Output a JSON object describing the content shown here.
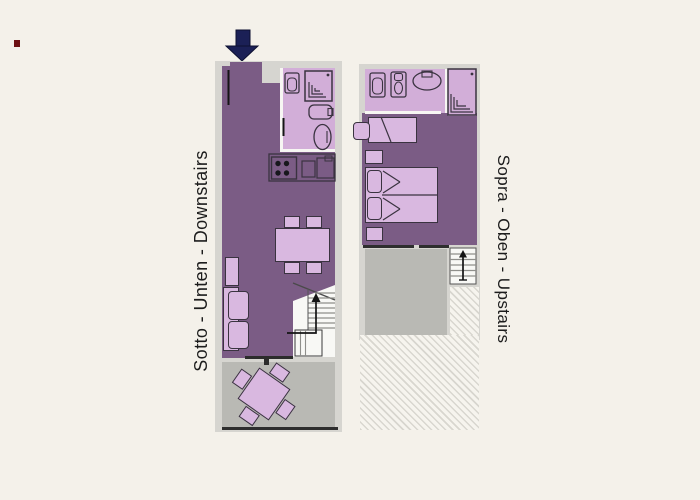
{
  "title": "Apartment floor plans",
  "floors": {
    "downstairs": {
      "label": "Sotto - Unten - Downstairs",
      "rooms": [
        "living-dining-room",
        "kitchen",
        "bathroom",
        "staircase",
        "terrace"
      ],
      "elements": [
        "entrance-arrow-icon",
        "toilet-icon",
        "shower-icon",
        "bathtub-icon",
        "bidet-icon",
        "stove-icon",
        "kitchen-sink-icon",
        "dining-table",
        "dining-chairs",
        "armchair",
        "sofa",
        "stairs-up-arrow-icon",
        "terrace-table"
      ]
    },
    "upstairs": {
      "label": "Sopra - Oben - Upstairs",
      "rooms": [
        "bedroom",
        "bathroom",
        "staircase",
        "terrace",
        "open-void"
      ],
      "elements": [
        "toilet-icon",
        "bidet-icon",
        "washbasin-icon",
        "shower-icon",
        "single-bed",
        "double-bed",
        "nightstand",
        "stairs-up-arrow-icon"
      ]
    }
  },
  "entrance": {
    "symbol": "down-arrow"
  },
  "colors": {
    "background": "#f4f1ea",
    "wall": "#d6d5d0",
    "wall-light": "#f7f6f3",
    "room-dark": "#7b5c85",
    "room-light": "#d2aed8",
    "furniture": "#d9b8e0",
    "furniture-outline": "#3a3340",
    "terrace": "#b9b9b4",
    "stairs-fill": "#f8f8f5",
    "hatch-line": "#d8d6cf",
    "hatch-bg": "#f6f4ee",
    "arrow-navy": "#1b2056",
    "line-dark": "#2e2e2e",
    "label-text": "#1c1c1c"
  }
}
